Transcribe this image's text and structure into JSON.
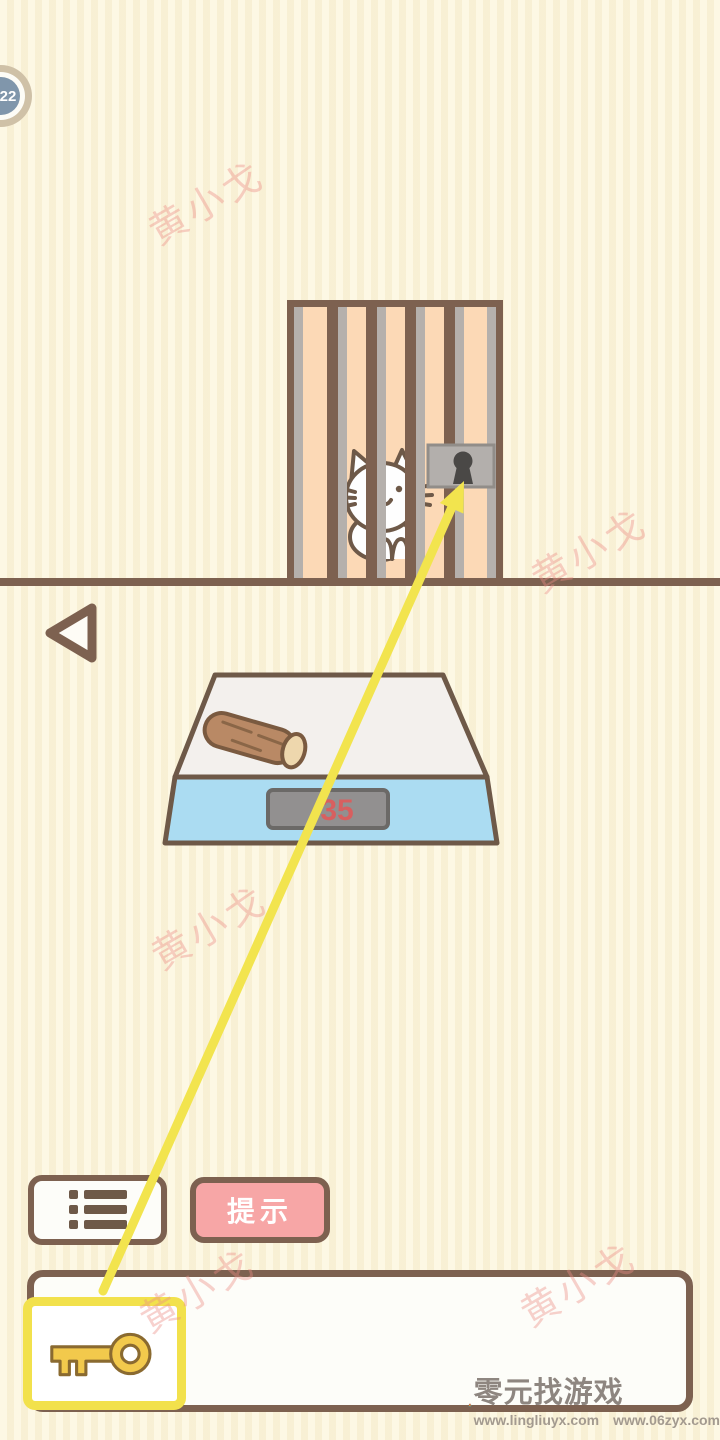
{
  "level_badge": {
    "value": "22"
  },
  "watermark": {
    "text": "黄小戈"
  },
  "scene": {
    "cage": {
      "lock_icon": "keyhole-icon",
      "cat": "white-cat"
    },
    "scale": {
      "display_value": "35",
      "item_on_scale": "wood-log"
    },
    "back_icon": "back-triangle-icon"
  },
  "toolbar": {
    "list_icon": "list-menu-icon",
    "hint_label": "提示"
  },
  "inventory": {
    "selected_item_icon": "key-icon"
  },
  "colors": {
    "accent_yellow": "#F2E14C",
    "arrow_yellow": "#F2E44E",
    "outline_brown": "#7D6150",
    "cage_peach": "#FCD9B6",
    "bar_gray": "#B5B0AC",
    "scale_blue": "#ABDCF2",
    "display_red": "#D85F5F",
    "button_pink": "#F7A6A6",
    "badge_blue": "#8096AB"
  },
  "footer": {
    "site_name": "零元找游戏",
    "url_left": "www.lingliuyx.com",
    "url_right": "www.06zyx.com"
  }
}
